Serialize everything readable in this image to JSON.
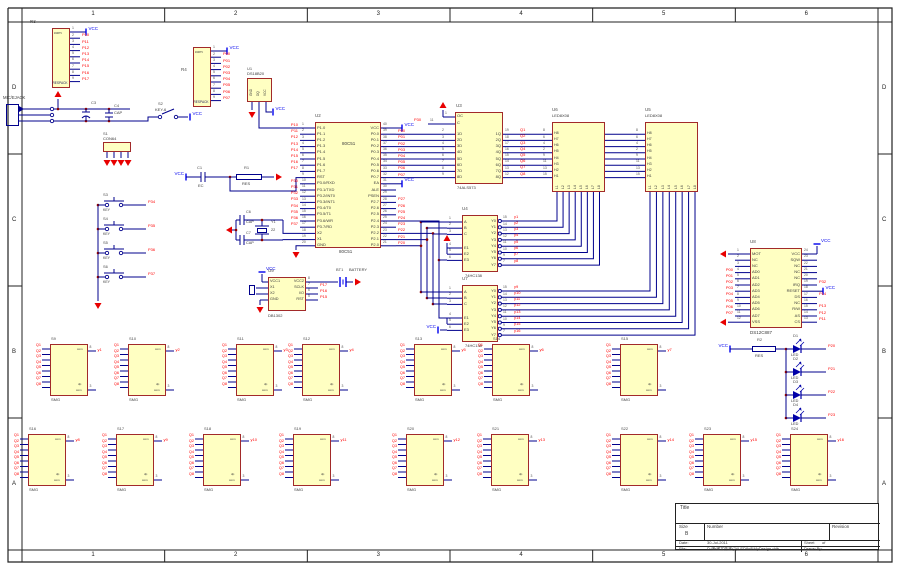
{
  "sheet": {
    "columns": [
      "1",
      "2",
      "3",
      "4",
      "5",
      "6"
    ],
    "rows": [
      "D",
      "C",
      "B",
      "A"
    ],
    "title_block": {
      "title_label": "Title",
      "size_label": "Size",
      "size": "B",
      "number_label": "Number",
      "revision_label": "Revision",
      "date_label": "Date:",
      "date": "30-Jul-2011",
      "sheet_label": "Sheet",
      "of_label": "of",
      "file_label": "File:",
      "file_path": "D:\\新建文件夹(2)\\LED8x8\\MyDesign.ddb",
      "drawn_by_label": "Drawn By:"
    }
  },
  "colors": {
    "component_fill": "#FFFFC2",
    "component_border": "#A22A2A",
    "wire": "#00008C",
    "net_label": "#FF0000",
    "vcc": "#0000EE",
    "ground": "#E80000",
    "segment": "#8B2222"
  },
  "power": {
    "vcc": "VCC"
  },
  "components": {
    "r3": {
      "ref": "R3",
      "inner": "com",
      "value": "RESPACK",
      "cn_label": "排阻",
      "pins": [
        [
          "1",
          "VCC"
        ],
        [
          "2",
          "P10"
        ],
        [
          "3",
          "P11"
        ],
        [
          "4",
          "P12"
        ],
        [
          "5",
          "P13"
        ],
        [
          "6",
          "P14"
        ],
        [
          "7",
          "P15"
        ],
        [
          "8",
          "P16"
        ],
        [
          "9",
          "P17"
        ]
      ]
    },
    "r4": {
      "ref": "R4",
      "inner": "com",
      "value": "RESPACK",
      "pins": [
        [
          "1",
          "VCC"
        ],
        [
          "2",
          "P00"
        ],
        [
          "3",
          "P01"
        ],
        [
          "4",
          "P02"
        ],
        [
          "5",
          "P03"
        ],
        [
          "6",
          "P04"
        ],
        [
          "7",
          "P05"
        ],
        [
          "8",
          "P06"
        ],
        [
          "9",
          "P07"
        ]
      ]
    },
    "mic": {
      "label": "MIC/EJACK",
      "c3": {
        "ref": "C3"
      },
      "c4": {
        "ref": "C4",
        "value": "CAP"
      },
      "s1": {
        "ref": "S1",
        "value": "CON64"
      },
      "s2": {
        "ref": "S2",
        "value": "KEY-6"
      }
    },
    "u1": {
      "ref": "U1",
      "value": "DS18B20",
      "pins": [
        "GND",
        "DQ",
        "VCC"
      ]
    },
    "u2": {
      "ref": "U2",
      "name": "80C51",
      "left": [
        [
          "1",
          "P1.0",
          "P10"
        ],
        [
          "2",
          "P1.1",
          "P11"
        ],
        [
          "3",
          "P1.2",
          "P12"
        ],
        [
          "4",
          "P1.3",
          "P13"
        ],
        [
          "5",
          "P1.4",
          "P14"
        ],
        [
          "6",
          "P1.5",
          "P15"
        ],
        [
          "7",
          "P1.6",
          "P16"
        ],
        [
          "8",
          "P1.7",
          "P17"
        ],
        [
          "9",
          "RST",
          ""
        ],
        [
          "10",
          "P3.0/RXD",
          "P30"
        ],
        [
          "11",
          "P3.1/TXD",
          "P31"
        ],
        [
          "12",
          "P3.2/INT0",
          "P32"
        ],
        [
          "13",
          "P3.3/INT1",
          "P33"
        ],
        [
          "14",
          "P3.4/T0",
          "P34"
        ],
        [
          "15",
          "P3.5/T1",
          "P35"
        ],
        [
          "16",
          "P3.6/WR",
          "P36"
        ],
        [
          "17",
          "P3.7/RD",
          "P37"
        ],
        [
          "18",
          "X2",
          ""
        ],
        [
          "19",
          "X1",
          ""
        ],
        [
          "20",
          "GND",
          ""
        ]
      ],
      "right": [
        [
          "40",
          "VCC",
          "VCC"
        ],
        [
          "39",
          "P0.0",
          "P00"
        ],
        [
          "38",
          "P0.1",
          "P01"
        ],
        [
          "37",
          "P0.2",
          "P02"
        ],
        [
          "36",
          "P0.3",
          "P03"
        ],
        [
          "35",
          "P0.4",
          "P04"
        ],
        [
          "34",
          "P0.5",
          "P05"
        ],
        [
          "33",
          "P0.6",
          "P06"
        ],
        [
          "32",
          "P0.7",
          "P07"
        ],
        [
          "31",
          "EA",
          "VCC"
        ],
        [
          "30",
          "ALE",
          ""
        ],
        [
          "29",
          "PSEN",
          ""
        ],
        [
          "28",
          "P2.7",
          "P27"
        ],
        [
          "27",
          "P2.6",
          "P26"
        ],
        [
          "26",
          "P2.5",
          "P25"
        ],
        [
          "25",
          "P2.4",
          "P24"
        ],
        [
          "24",
          "P2.3",
          "P23"
        ],
        [
          "23",
          "P2.2",
          "P22"
        ],
        [
          "22",
          "P2.1",
          "P21"
        ],
        [
          "21",
          "P2.0",
          "P20"
        ]
      ]
    },
    "reset": {
      "c_ref": "C1",
      "c_value": "EC",
      "r_ref": "R1",
      "r_value": "RES"
    },
    "xtal": {
      "c1_ref": "C6",
      "c2_ref": "C7",
      "cap": "CAP",
      "y_ref": "Y1",
      "y_value": "22"
    },
    "keys": {
      "value": "KEY",
      "items": [
        [
          "S3",
          "P34"
        ],
        [
          "S4",
          "P35"
        ],
        [
          "S5",
          "P36"
        ],
        [
          "S6",
          "P37"
        ]
      ]
    },
    "u3": {
      "ref": "U3",
      "value": "74ALS573",
      "ctrl": [
        [
          "1",
          "OC",
          ""
        ],
        [
          "11",
          "C",
          "P30"
        ]
      ],
      "d": [
        [
          "2",
          "1D"
        ],
        [
          "3",
          "2D"
        ],
        [
          "4",
          "3D"
        ],
        [
          "5",
          "4D"
        ],
        [
          "6",
          "5D"
        ],
        [
          "7",
          "6D"
        ],
        [
          "8",
          "7D"
        ],
        [
          "9",
          "8D"
        ]
      ],
      "q": [
        [
          "19",
          "1Q",
          "Q1"
        ],
        [
          "18",
          "2Q",
          "Q2"
        ],
        [
          "17",
          "3Q",
          "Q3"
        ],
        [
          "16",
          "4Q",
          "Q4"
        ],
        [
          "15",
          "5Q",
          "Q5"
        ],
        [
          "14",
          "6Q",
          "Q6"
        ],
        [
          "13",
          "7Q",
          "Q7"
        ],
        [
          "12",
          "8Q",
          "Q8"
        ]
      ]
    },
    "u4": {
      "ref": "U4",
      "value": "74HC138",
      "abc": [
        [
          "1",
          "A"
        ],
        [
          "2",
          "B"
        ],
        [
          "3",
          "C"
        ]
      ],
      "en": [
        [
          "4",
          "E1"
        ],
        [
          "5",
          "E2"
        ],
        [
          "6",
          "E3"
        ]
      ],
      "y": [
        [
          "15",
          "Y0",
          "y1"
        ],
        [
          "14",
          "Y1",
          "y2"
        ],
        [
          "13",
          "Y2",
          "y3"
        ],
        [
          "12",
          "Y3",
          "y4"
        ],
        [
          "11",
          "Y4",
          "y5"
        ],
        [
          "10",
          "Y5",
          "y6"
        ],
        [
          "9",
          "Y6",
          "y7"
        ],
        [
          "7",
          "Y7",
          "y8"
        ]
      ]
    },
    "u7": {
      "ref": "U7",
      "value": "74HC138",
      "abc": [
        [
          "1",
          "A"
        ],
        [
          "2",
          "B"
        ],
        [
          "3",
          "C"
        ]
      ],
      "en": [
        [
          "4",
          "E1"
        ],
        [
          "5",
          "E2"
        ],
        [
          "6",
          "E3"
        ]
      ],
      "y": [
        [
          "15",
          "Y0",
          "y9"
        ],
        [
          "14",
          "Y1",
          "y10"
        ],
        [
          "13",
          "Y2",
          "y11"
        ],
        [
          "12",
          "Y3",
          "y12"
        ],
        [
          "11",
          "Y4",
          "y13"
        ],
        [
          "10",
          "Y5",
          "y14"
        ],
        [
          "9",
          "Y6",
          "y15"
        ],
        [
          "7",
          "Y7",
          "y16"
        ]
      ]
    },
    "u6": {
      "ref": "U6",
      "value": "LED8X08",
      "h": [
        [
          "8",
          "H8"
        ],
        [
          "6",
          "H7"
        ],
        [
          "4",
          "H6"
        ],
        [
          "2",
          "H5"
        ],
        [
          "9",
          "H4"
        ],
        [
          "11",
          "H3"
        ],
        [
          "13",
          "H2"
        ],
        [
          "15",
          "H1"
        ]
      ],
      "l": [
        "L1",
        "L2",
        "L3",
        "L4",
        "L5",
        "L6",
        "L7",
        "L8"
      ]
    },
    "u5": {
      "ref": "U5",
      "value": "LED8X08",
      "h": [
        [
          "8",
          "H8"
        ],
        [
          "6",
          "H7"
        ],
        [
          "4",
          "H6"
        ],
        [
          "2",
          "H5"
        ],
        [
          "9",
          "H4"
        ],
        [
          "11",
          "H3"
        ],
        [
          "13",
          "H2"
        ],
        [
          "15",
          "H1"
        ]
      ],
      "l": [
        "L1",
        "L2",
        "L3",
        "L4",
        "L5",
        "L6",
        "L7",
        "L8"
      ]
    },
    "u8": {
      "ref": "U8",
      "value": "DS12C887",
      "left": [
        [
          "1",
          "MOT",
          ""
        ],
        [
          "2",
          "NC",
          ""
        ],
        [
          "3",
          "NC",
          ""
        ],
        [
          "4",
          "AD0",
          "P00"
        ],
        [
          "5",
          "AD1",
          "P01"
        ],
        [
          "6",
          "AD2",
          "P02"
        ],
        [
          "7",
          "AD3",
          "P03"
        ],
        [
          "8",
          "AD4",
          "P04"
        ],
        [
          "9",
          "AD5",
          "P05"
        ],
        [
          "10",
          "AD6",
          "P06"
        ],
        [
          "11",
          "AD7",
          "P07"
        ],
        [
          "12",
          "VSS",
          ""
        ]
      ],
      "right": [
        [
          "24",
          "VCC",
          ""
        ],
        [
          "23",
          "SQW",
          ""
        ],
        [
          "22",
          "NC",
          ""
        ],
        [
          "21",
          "NC",
          ""
        ],
        [
          "20",
          "NC",
          ""
        ],
        [
          "19",
          "IRQ",
          "P32"
        ],
        [
          "18",
          "RESET",
          "VCC"
        ],
        [
          "17",
          "DS",
          "P14"
        ],
        [
          "16",
          "NC",
          ""
        ],
        [
          "15",
          "R/W",
          "P13"
        ],
        [
          "14",
          "AS",
          "P12"
        ],
        [
          "13",
          "CS",
          "P11"
        ]
      ]
    },
    "u9": {
      "ref": "U9",
      "value": "DB1302",
      "left": [
        "VCC1",
        "X1",
        "X2",
        "GND"
      ],
      "right": [
        [
          "8",
          "VCC2",
          ""
        ],
        [
          "7",
          "SCLK",
          "P17"
        ],
        [
          "6",
          "I/O",
          "P16"
        ],
        [
          "5",
          "RST",
          "P15"
        ]
      ]
    },
    "bt1": {
      "ref": "BT1",
      "value": "BATTERY"
    },
    "led_block": {
      "r_ref": "R2",
      "r_value": "RES",
      "diodes": [
        [
          "D1",
          "LED",
          "P20"
        ],
        [
          "D2",
          "LED",
          "P21"
        ],
        [
          "D3",
          "LED",
          "P22"
        ],
        [
          "D4",
          "LED",
          "P23"
        ]
      ]
    },
    "displays": {
      "value": "SMG",
      "com": "com",
      "dp": "dp",
      "pin_com": "8",
      "pin_bot": "3",
      "segs": [
        "Q1",
        "Q2",
        "Q3",
        "Q4",
        "Q5",
        "Q6",
        "Q7",
        "Q8"
      ],
      "top": [
        [
          "S9",
          "y1"
        ],
        [
          "S10",
          "y2"
        ],
        [
          "S11",
          "y3"
        ],
        [
          "S12",
          "y4"
        ],
        [
          "S13",
          "y5"
        ],
        [
          "S14",
          "y6"
        ],
        [
          "S15",
          "y7"
        ]
      ],
      "bottom": [
        [
          "S16",
          "y8"
        ],
        [
          "S17",
          "y9"
        ],
        [
          "S18",
          "y10"
        ],
        [
          "S19",
          "y11"
        ],
        [
          "S20",
          "y12"
        ],
        [
          "S21",
          "y13"
        ],
        [
          "S22",
          "y14"
        ],
        [
          "S23",
          "y15"
        ],
        [
          "S24",
          "y16"
        ]
      ]
    }
  }
}
